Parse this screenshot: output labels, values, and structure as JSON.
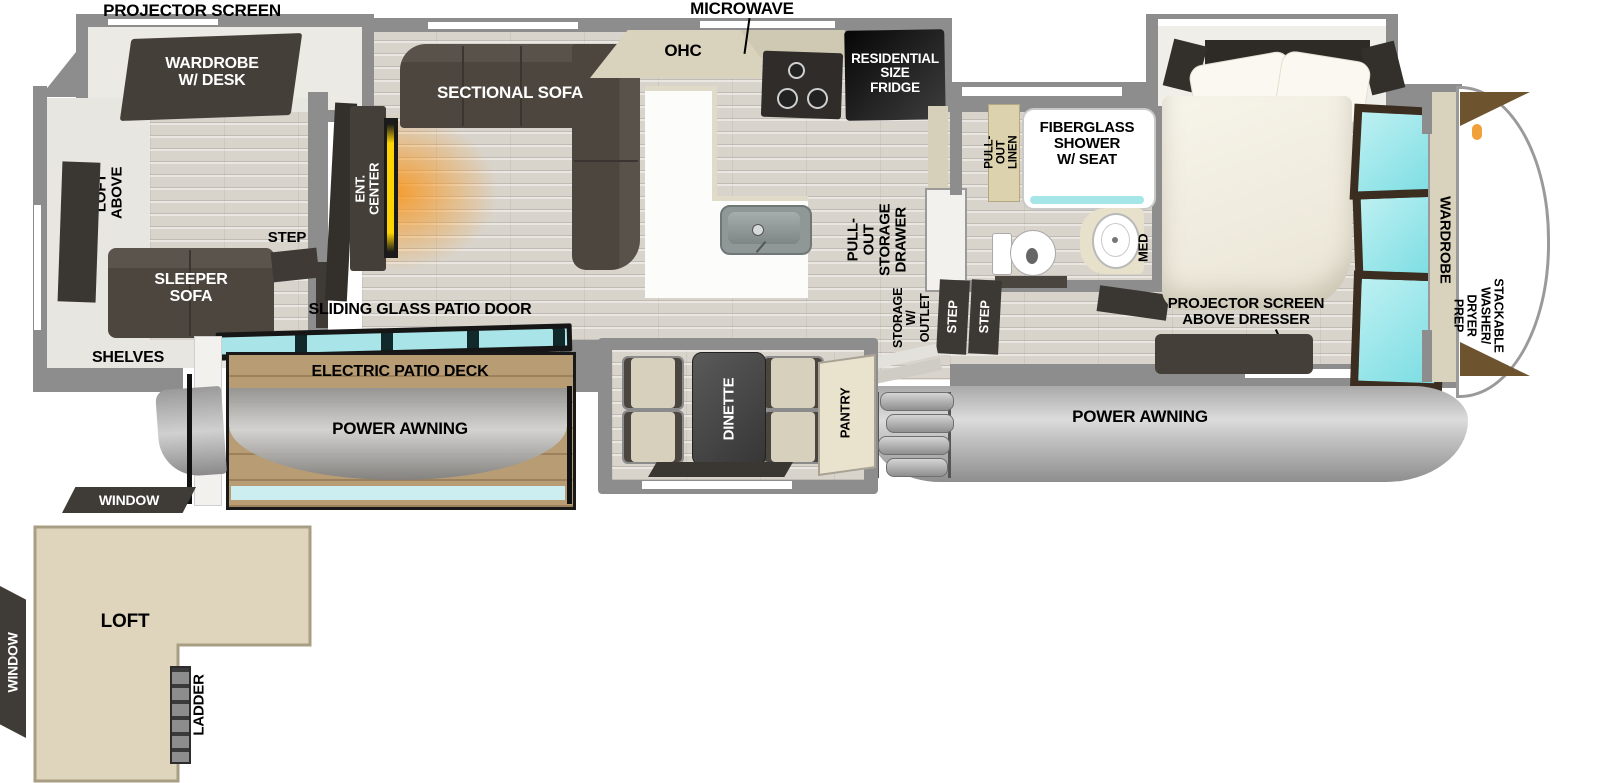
{
  "plan": {
    "rear": {
      "projector_screen": "PROJECTOR SCREEN",
      "wardrobe_desk": "WARDROBE\nW/ DESK",
      "loft_above": "LOFT ABOVE",
      "sleeper_sofa": "SLEEPER\nSOFA",
      "shelves": "SHELVES",
      "step": "STEP"
    },
    "living": {
      "ent_center": "ENT. CENTER",
      "sectional_sofa": "SECTIONAL SOFA",
      "ohc": "OHC",
      "sliding_door": "SLIDING GLASS PATIO DOOR"
    },
    "kitchen": {
      "microwave": "MICROWAVE",
      "fridge": "RESIDENTIAL\nSIZE\nFRIDGE",
      "pullout_drawer": "PULL-OUT\nSTORAGE\nDRAWER",
      "pantry": "PANTRY",
      "dinette": "DINETTE"
    },
    "bath": {
      "pullout_linen": "PULL-OUT\nLINEN",
      "shower": "FIBERGLASS\nSHOWER\nW/ SEAT",
      "med": "MED",
      "storage_outlet": "STORAGE\nW/ OUTLET",
      "step_a": "STEP",
      "step_b": "STEP"
    },
    "bedroom": {
      "projector_dresser": "PROJECTOR SCREEN\nABOVE DRESSER",
      "wardrobe": "WARDROBE",
      "stackable": "STACKABLE\nWASHER/\nDRYER PREP"
    },
    "exterior": {
      "awning_right": "POWER AWNING",
      "awning_left": "POWER AWNING",
      "deck": "ELECTRIC PATIO DECK",
      "window_top": "WINDOW",
      "window_left": "WINDOW"
    },
    "loft": {
      "loft": "LOFT",
      "ladder": "LADDER"
    }
  },
  "colors": {
    "wall": "#8d8d8d",
    "furniture_dark": "#453f39",
    "tan": "#ded5bc",
    "teal_glass": "#8fdde2",
    "deck_wood": "#b79c74",
    "awning_gray": "#bdbdbd",
    "fire_glow": "#f7941d"
  }
}
